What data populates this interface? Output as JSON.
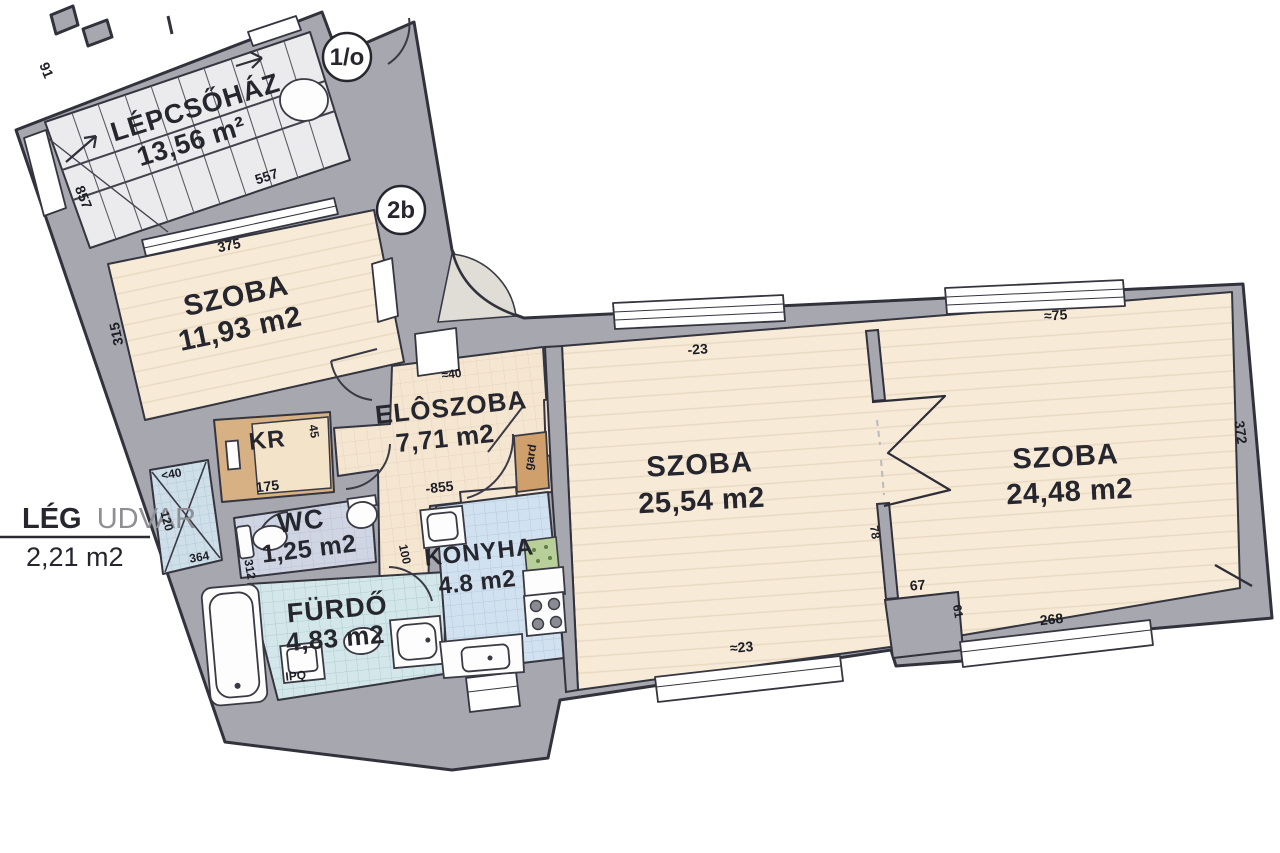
{
  "plan_title": "Apartment floor plan",
  "watermark": "GDN",
  "markers": {
    "upper": "1/o",
    "lower": "2b"
  },
  "rooms": [
    {
      "id": "lepcsohaz",
      "name": "LÉPCSŐHÁZ",
      "area": "13,56 m²"
    },
    {
      "id": "szoba1",
      "name": "SZOBA",
      "area": "11,93 m2"
    },
    {
      "id": "eloszoba",
      "name": "ELÔSZOBA",
      "area": "7,71 m2"
    },
    {
      "id": "kr",
      "name": "KR",
      "area": ""
    },
    {
      "id": "wc",
      "name": "WC",
      "area": "1,25 m2"
    },
    {
      "id": "furdo",
      "name": "FÜRDŐ",
      "area": "4,83 m2"
    },
    {
      "id": "konyha",
      "name": "KONYHA",
      "area": "4.8 m2"
    },
    {
      "id": "szoba2",
      "name": "SZOBA",
      "area": "25,54 m2"
    },
    {
      "id": "szoba3",
      "name": "SZOBA",
      "area": "24,48 m2"
    },
    {
      "id": "legudvar",
      "name_bold": "LÉG",
      "name_rest": "UDVAR",
      "area": "2,21 m2"
    }
  ],
  "appliances": {
    "washer": "IPQ",
    "cabinet": "gard"
  },
  "dims": {
    "szoba1_top": "375",
    "szoba1_left": "315",
    "stair_inner": "557",
    "stair_left": "857",
    "stair_left_top": "91",
    "kr_bottom": "175",
    "kr_right": "45",
    "entry_opening": "≈40",
    "shaft_top": "<40",
    "shaft_left": "120",
    "shaft_bottom": "364",
    "wc_left": "312",
    "hall_passage": "100",
    "eloszoba_bottom": "-855",
    "szoba2_top": "-23",
    "szoba2_bottom": "≈23",
    "szoba3_top": "≈75",
    "szoba3_right": "372",
    "divider_mid": "78",
    "divider_low": "67",
    "pillar_right": "61",
    "szoba3_bottom": "268"
  },
  "colors": {
    "wall": "#a7a7b0",
    "outline": "#32323c",
    "stair_floor": "#ebebee",
    "room_cream": "#f7ead6",
    "wood": "#d7b184",
    "shaft_blue": "#cfdfe9",
    "wc_floor": "#d0d5e3",
    "bath_tile": "#d3e6e9",
    "kitchen_tile": "#d2e1ef"
  }
}
